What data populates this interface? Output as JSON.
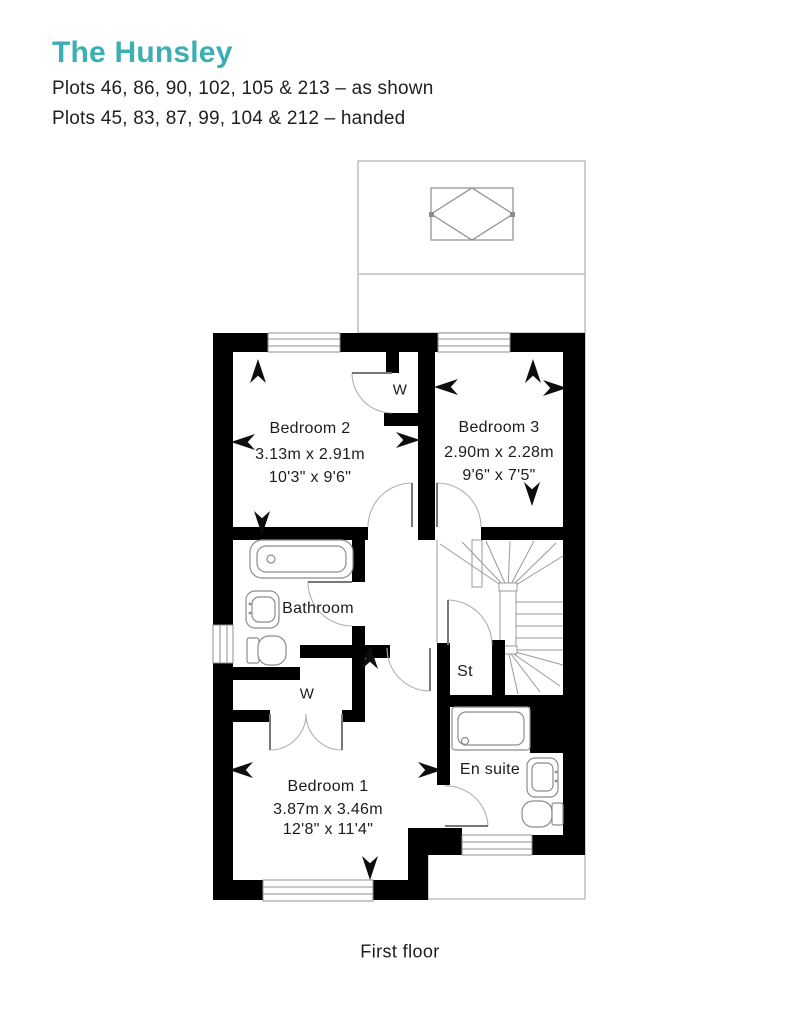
{
  "header": {
    "title": "The Hunsley",
    "plots_as_shown": "Plots 46, 86, 90, 102, 105 & 213 – as shown",
    "plots_handed": "Plots 45, 83, 87, 99, 104 & 212 – handed",
    "accent_color": "#3BAFB2"
  },
  "rooms": {
    "bedroom2": {
      "name": "Bedroom 2",
      "metric": "3.13m x 2.91m",
      "imperial": "10'3\" x 9'6\""
    },
    "bedroom3": {
      "name": "Bedroom 3",
      "metric": "2.90m x 2.28m",
      "imperial": "9'6\" x 7'5\""
    },
    "bedroom1": {
      "name": "Bedroom 1",
      "metric": "3.87m x 3.46m",
      "imperial": "12'8\" x 11'4\""
    },
    "bathroom": {
      "name": "Bathroom"
    },
    "ensuite": {
      "name": "En suite"
    },
    "storage": {
      "name": "St"
    },
    "wardrobe_top": {
      "name": "W"
    },
    "wardrobe_bottom": {
      "name": "W"
    }
  },
  "footer": {
    "caption": "First floor"
  },
  "icons": {
    "dimension_arrow": "black concave dart (css clip-path)"
  },
  "colors": {
    "walls": "#000000",
    "thin_outline": "#b3b3b3",
    "fixtures": "#8c8c8c",
    "text": "#1c1c1c"
  }
}
